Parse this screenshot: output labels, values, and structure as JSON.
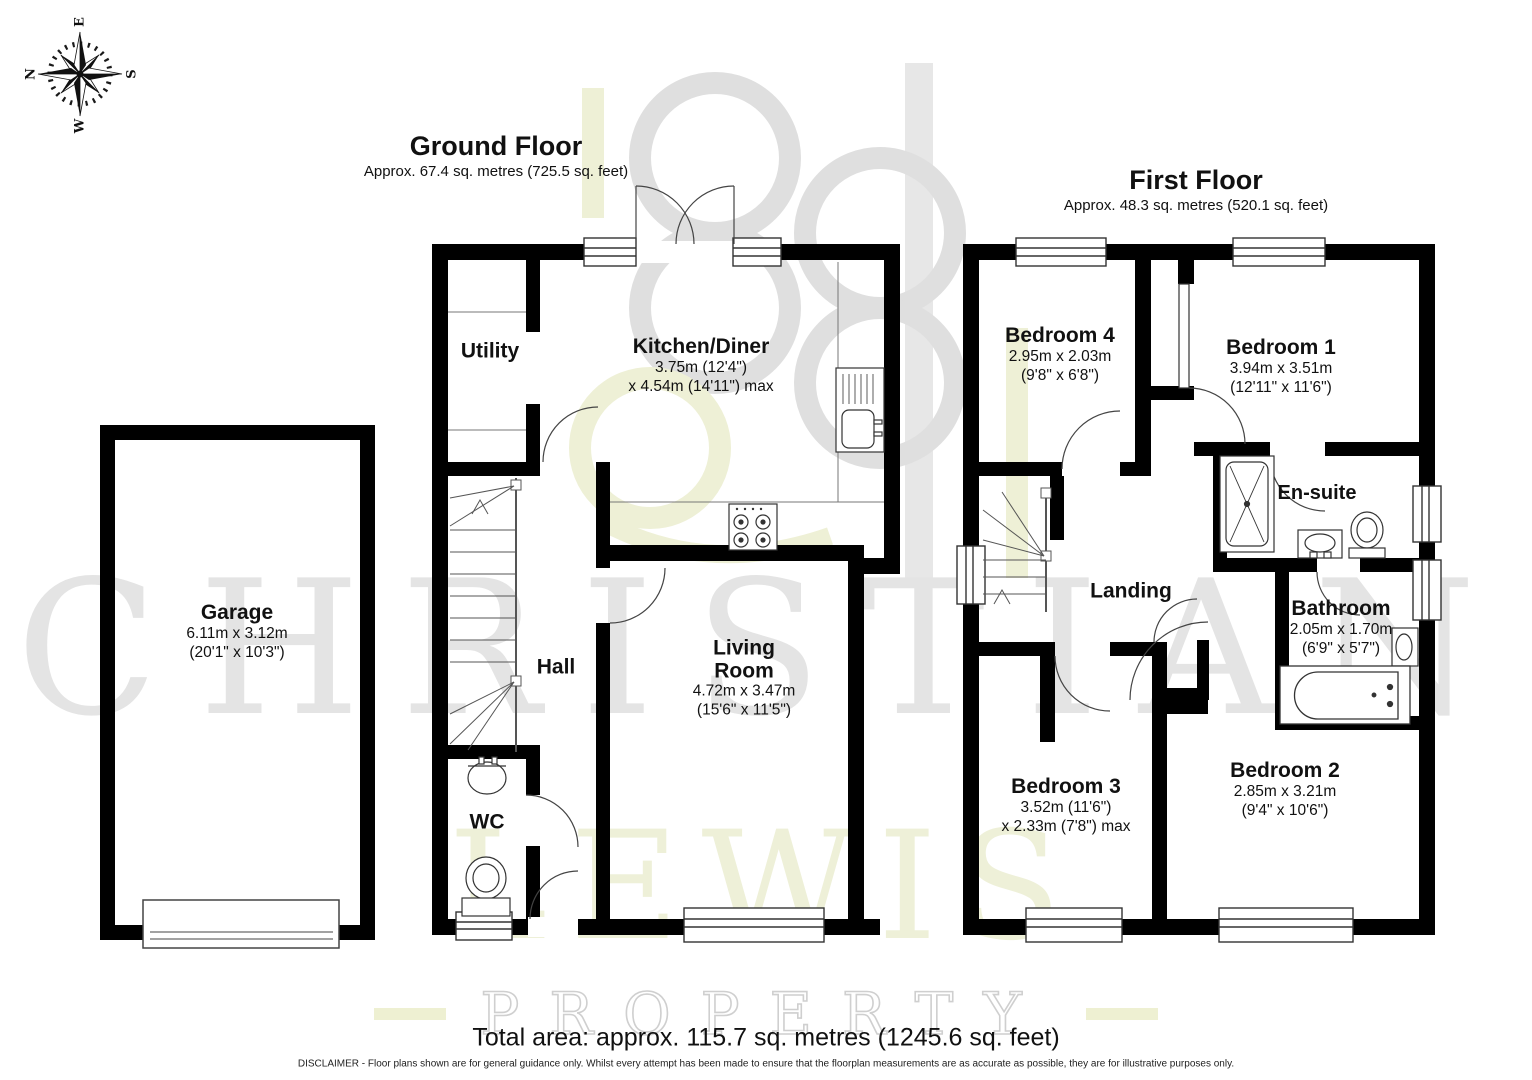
{
  "compass": {
    "n": "N",
    "e": "E",
    "s": "S",
    "w": "W"
  },
  "ground_floor": {
    "title": "Ground Floor",
    "subtitle": "Approx. 67.4 sq. metres (725.5 sq. feet)"
  },
  "first_floor": {
    "title": "First Floor",
    "subtitle": "Approx. 48.3 sq. metres (520.1 sq. feet)"
  },
  "garage": {
    "name": "Garage",
    "dim1": "6.11m x 3.12m",
    "dim2": "(20'1\" x 10'3\")"
  },
  "rooms_ground": {
    "utility": {
      "name": "Utility"
    },
    "kitchen": {
      "name": "Kitchen/Diner",
      "dim1": "3.75m (12'4\")",
      "dim2": "x 4.54m (14'11\") max"
    },
    "hall": {
      "name": "Hall"
    },
    "wc": {
      "name": "WC"
    },
    "living": {
      "line1": "Living",
      "line2": "Room",
      "dim1": "4.72m x 3.47m",
      "dim2": "(15'6\" x 11'5\")"
    }
  },
  "rooms_first": {
    "bedroom4": {
      "name": "Bedroom 4",
      "dim1": "2.95m x 2.03m",
      "dim2": "(9'8\" x 6'8\")"
    },
    "bedroom1": {
      "name": "Bedroom 1",
      "dim1": "3.94m x 3.51m",
      "dim2": "(12'11\" x 11'6\")"
    },
    "ensuite": {
      "name": "En-suite"
    },
    "landing": {
      "name": "Landing"
    },
    "bathroom": {
      "name": "Bathroom",
      "dim1": "2.05m x 1.70m",
      "dim2": "(6'9\" x 5'7\")"
    },
    "bedroom3": {
      "name": "Bedroom 3",
      "dim1": "3.52m (11'6\")",
      "dim2": "x 2.33m (7'8\") max"
    },
    "bedroom2": {
      "name": "Bedroom 2",
      "dim1": "2.85m x 3.21m",
      "dim2": "(9'4\" x 10'6\")"
    }
  },
  "footer": {
    "total_area": "Total area: approx. 115.7 sq. metres (1245.6 sq. feet)",
    "disclaimer": "DISCLAIMER -  Floor plans shown are for general guidance only. Whilst every attempt has been made to ensure that the floorplan measurements are as accurate as possible, they are for illustrative purposes only."
  },
  "watermark": {
    "line1": "CHRISTIAN",
    "line2": "LEWIS",
    "line3": "PROPERTY"
  },
  "colors": {
    "wall": "#000000",
    "watermark_gray": "#e4e4e4",
    "watermark_green": "#eef0d8"
  }
}
